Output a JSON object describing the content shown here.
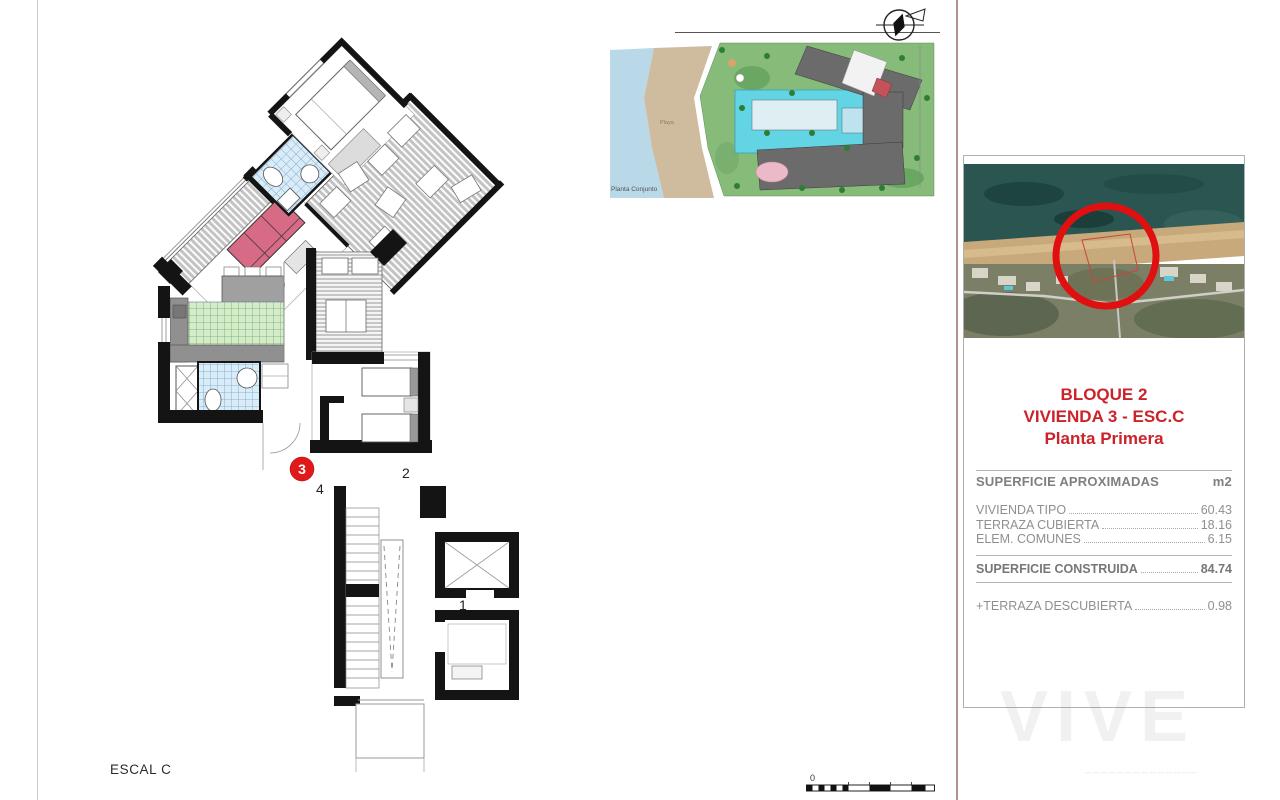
{
  "page": {
    "escal_label": "ESCAL C",
    "scale_zero": "0"
  },
  "floor_plan": {
    "unit_labels": {
      "unit1": "1",
      "unit2": "2",
      "unit3": "3",
      "unit4": "4"
    }
  },
  "site_plan": {
    "caption": "Planta Conjunto",
    "beach_label": "Playa"
  },
  "panel": {
    "title_line1": "BLOQUE 2",
    "title_line2": "VIVIENDA 3 - ESC.C",
    "title_line3": "Planta Primera",
    "table": {
      "header_label": "SUPERFICIE APROXIMADAS",
      "header_unit": "m2",
      "rows": [
        {
          "label": "VIVIENDA TIPO",
          "value": "60.43"
        },
        {
          "label": "TERRAZA CUBIERTA",
          "value": "18.16"
        },
        {
          "label": "ELEM. COMUNES",
          "value": "6.15"
        }
      ],
      "total_label": "SUPERFICIE CONSTRUIDA",
      "total_value": "84.74",
      "extra_label": "+TERRAZA DESCUBIERTA",
      "extra_value": "0.98"
    }
  },
  "watermark": "VIVE",
  "colors": {
    "accent_red": "#cc2229",
    "unit_circle_red": "#e01a1a",
    "sofa_pink": "#d76a85",
    "bath_blue": "#d9ecf7",
    "kitchen_green": "#d4ecca",
    "pool_cyan": "#62d4e4",
    "water_blue": "#b9d8e8",
    "beach_tan": "#cfbb9e",
    "site_green": "#86bb7a",
    "building_gray": "#6b6b6b"
  }
}
